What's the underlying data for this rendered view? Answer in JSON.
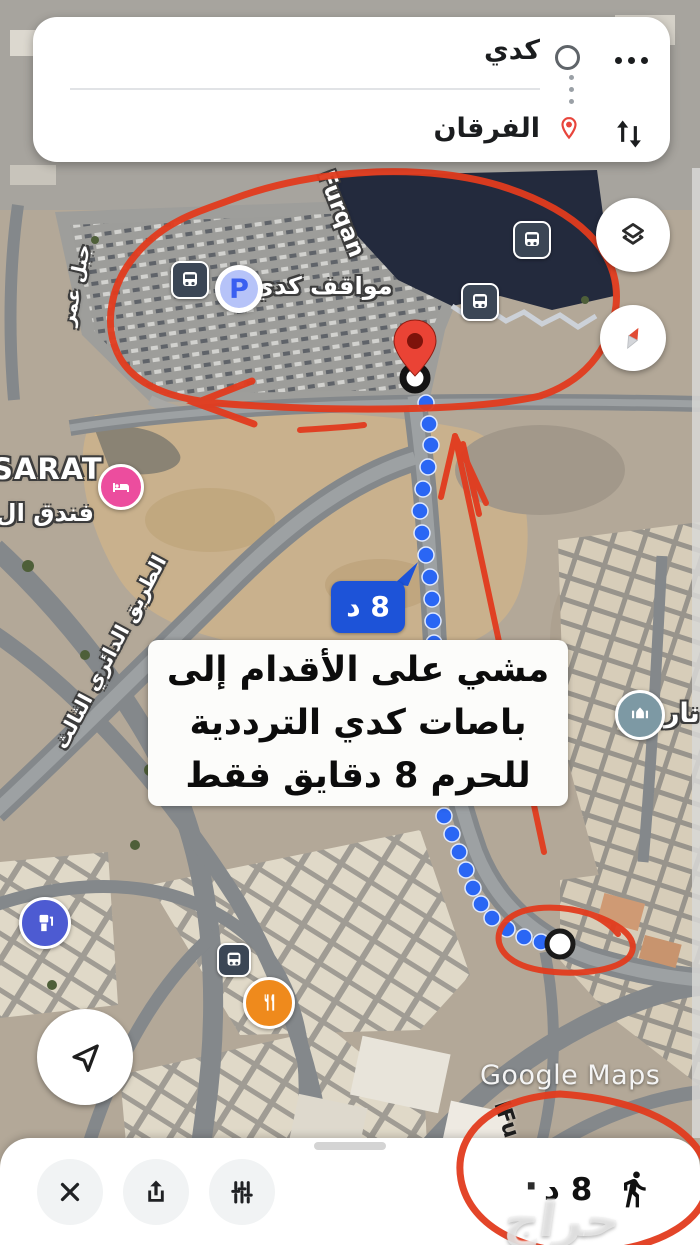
{
  "route_card": {
    "origin_value": "كدي",
    "destination_value": "الفرقان"
  },
  "map": {
    "labels": {
      "parking": "مواقف كدي",
      "furqan_street": "Furqan",
      "sarat": "SARAT",
      "hotel_partial": "فندق ال...",
      "ring_road": "الطريق الدائري الثالث",
      "hill": "جبل عمر",
      "right_partial": "نار",
      "bottom_street": "lFu",
      "google_watermark": "Google Maps"
    },
    "parking_letter": "P",
    "flag": "8 د",
    "note": {
      "l1": "مشي على الأقدام إلى",
      "l2": "باصات كدي الترددية",
      "l3": "للحرم 8 دقايق فقط"
    }
  },
  "bottom": {
    "duration": "8 د",
    "dot": "·",
    "watermark": "حراج"
  },
  "colors": {
    "annotation_red": "#e23b1e",
    "route_blue": "#2a66f4",
    "flag_blue": "#1d53d8",
    "pin_red": "#ea4335",
    "hotel_pink": "#ec4d9e",
    "restaurant_orange": "#ef8a1c",
    "fuel_blue": "#4d5bd2",
    "mosque_teal": "#7d99a4",
    "bus_dark": "#3b4655"
  }
}
